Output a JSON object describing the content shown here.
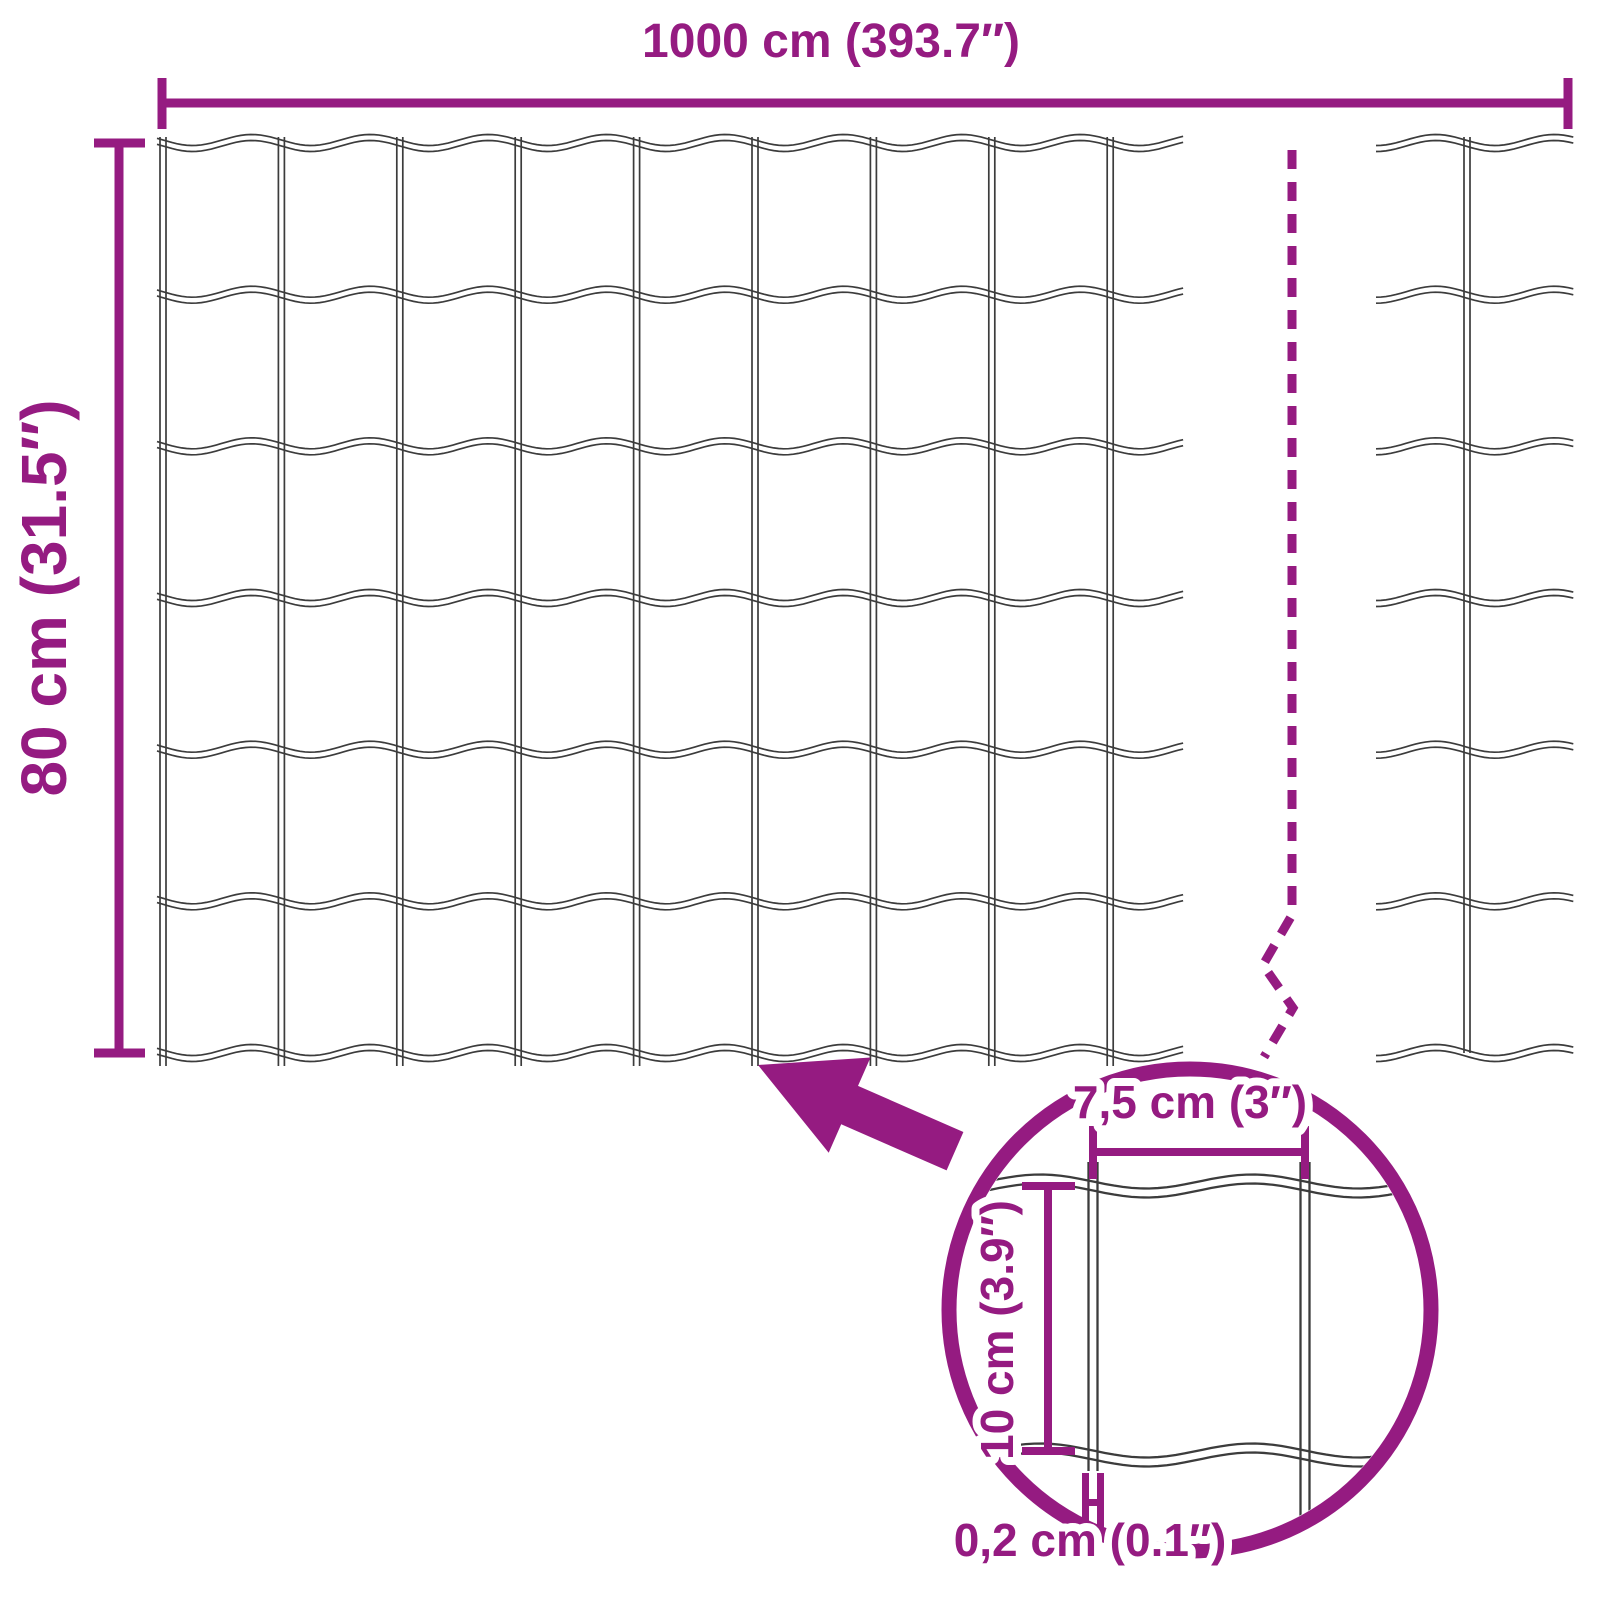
{
  "title": "Wire mesh fence dimension diagram",
  "colors": {
    "accent": "#951B81",
    "wire": "#3C3C3C",
    "background": "#FFFFFF"
  },
  "dimensions": {
    "total_width_label": "1000 cm (393.7″)",
    "total_height_label": "80 cm (31.5″)",
    "mesh_opening_width_label": "7,5 cm (3″)",
    "mesh_opening_height_label": "10 cm (3.9″)",
    "wire_thickness_label": "0,2 cm (0.1″)"
  },
  "figure": {
    "rows_y": [
      143,
      294.7,
      446.3,
      598,
      749.7,
      901.3,
      1053
    ],
    "wave": {
      "amplitude": 5.5,
      "period": 118.4,
      "line_gap": 6,
      "stroke_width": 1.7
    },
    "left_panel": {
      "wavy_x_start": 157,
      "wavy_x_end": 1188,
      "vertical_count": 9,
      "vertical_x_start": 163,
      "vertical_spacing": 118.4,
      "vertical_y_top": 137,
      "vertical_y_bottom": 1066,
      "wave_phase_x": 163
    },
    "right_panel": {
      "wavy_x_start": 1376,
      "wavy_x_end": 1575,
      "vertical_x": 1467,
      "vertical_y_top": 137,
      "vertical_y_bottom": 1053
    },
    "break_line": {
      "x": 1292,
      "y_top": 150,
      "y_zigzag": [
        [
          1292,
          915
        ],
        [
          1263,
          965
        ],
        [
          1293,
          1008
        ],
        [
          1264,
          1057
        ]
      ]
    },
    "detail": {
      "center_x": 1190,
      "center_y": 1310,
      "radius": 241,
      "clip_radius": 233,
      "wave": {
        "amplitude": 7,
        "period": 212,
        "line_gap": 9,
        "stroke_width": 2.3
      },
      "wavy_rows_y": [
        1186,
        1455
      ],
      "wavy_x_start": 946,
      "wavy_x_end": 1437,
      "wave_phase_x": 1093,
      "verticals": [
        {
          "x": 1093,
          "y_top": 1162,
          "y_bottom": 1471
        },
        {
          "x": 1305,
          "y_top": 1162,
          "y_bottom": 1542
        }
      ]
    }
  }
}
